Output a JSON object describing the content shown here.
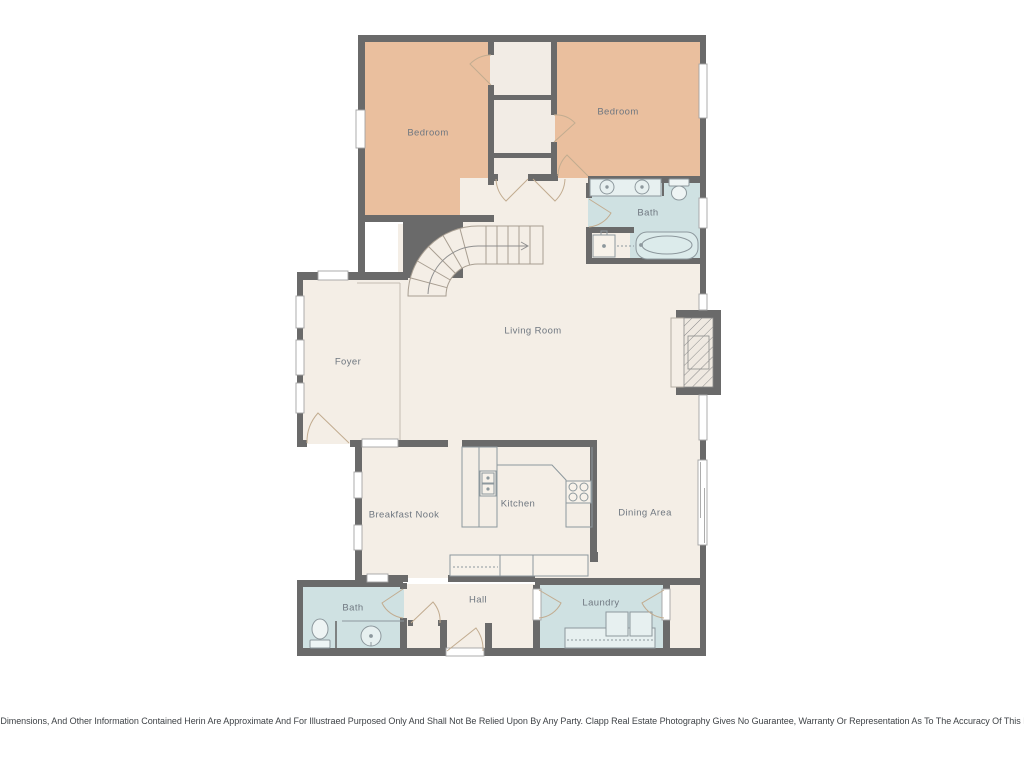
{
  "colors": {
    "wall": "#6a6a6a",
    "bedroom": "#eabf9e",
    "cream": "#f4eee6",
    "closet": "#f2ece5",
    "bath": "#cfe1e2",
    "window_frame": "#a3a3a3",
    "fixture": "#8d989d",
    "door": "#c2ac90",
    "stair_line": "#a89e91",
    "hatch_line": "#8b8b8b"
  },
  "rooms": {
    "bedroom_left": {
      "label": "Bedroom"
    },
    "bedroom_right": {
      "label": "Bedroom"
    },
    "bath_upper": {
      "label": "Bath"
    },
    "living_room": {
      "label": "Living Room"
    },
    "foyer": {
      "label": "Foyer"
    },
    "breakfast_nook": {
      "label": "Breakfast Nook"
    },
    "kitchen": {
      "label": "Kitchen"
    },
    "dining_area": {
      "label": "Dining Area"
    },
    "bath_lower": {
      "label": "Bath"
    },
    "hall": {
      "label": "Hall"
    },
    "laundry": {
      "label": "Laundry"
    }
  },
  "footer": {
    "disclaimer": "All Images, Dimensions, And Other Information Contained Herin Are Approximate And For Illustraed Purposed Only And Shall Not Be Relied Upon By Any Party. Clapp Real Estate Photography Gives No Guarantee, Warranty Or Representation As To The Accuracy Of This Information."
  }
}
